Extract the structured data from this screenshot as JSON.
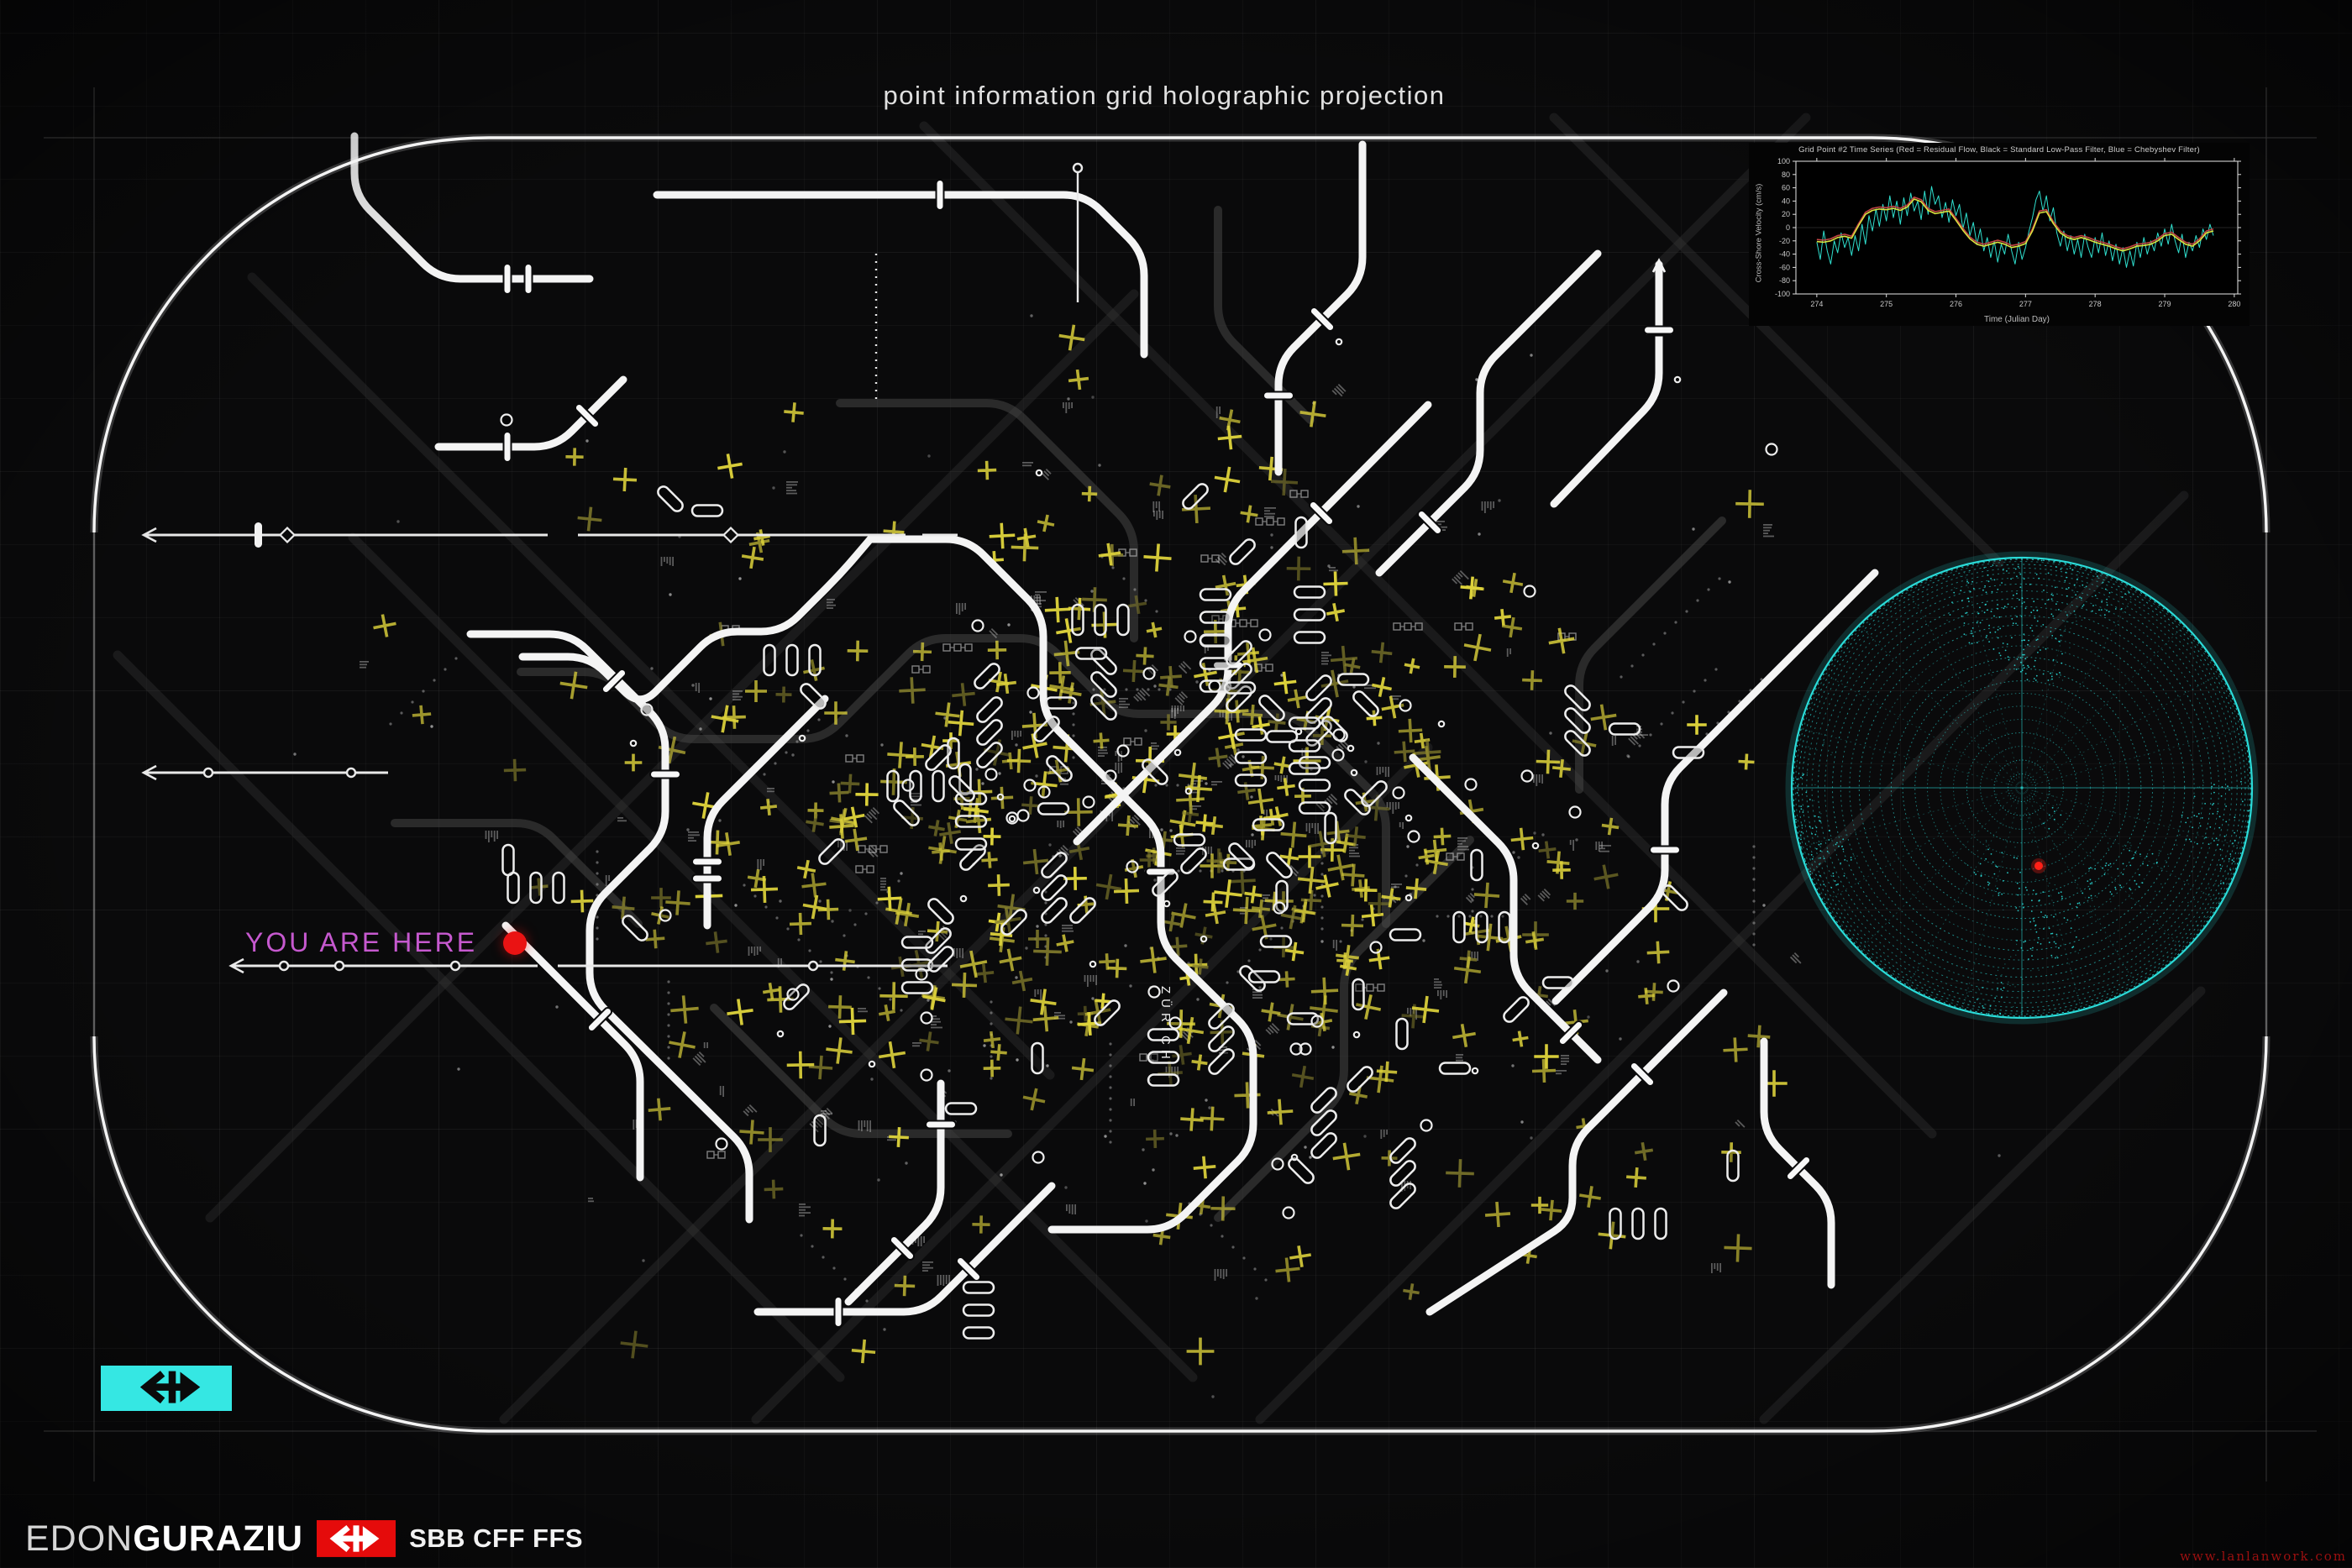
{
  "page": {
    "title": "point information grid holographic projection"
  },
  "map": {
    "you_are_here": "YOU ARE HERE",
    "city_label": "ZÜRICH",
    "colors": {
      "background": "#0a0a0b",
      "route_white": "#f4f4f4",
      "route_dim": "#434343",
      "mark_yellow": "#ddd23b",
      "mark_yellow_dim": "#86802d",
      "label_magenta": "#c659cf",
      "locator_red": "#ea1313",
      "frame_white": "#f2f2f2"
    }
  },
  "chart_data": {
    "type": "line",
    "title": "Grid Point #2 Time Series (Red = Residual Flow, Black = Standard Low-Pass Filter, Blue = Chebyshev Filter)",
    "xlabel": "Time (Julian Day)",
    "ylabel": "Cross-Shore Velocity (cm/s)",
    "xlim": [
      273.7,
      280.05
    ],
    "ylim": [
      -100,
      100
    ],
    "xticks": [
      274,
      275,
      276,
      277,
      278,
      279,
      280
    ],
    "yticks": [
      -100,
      -80,
      -60,
      -40,
      -20,
      0,
      20,
      40,
      60,
      80,
      100
    ],
    "grid": false,
    "legend_position": "none",
    "series": [
      {
        "name": "Residual Flow",
        "color": "#2fe0cf",
        "style": "noisy",
        "x_start": 274.0,
        "x_step": 0.05,
        "values": [
          -22,
          -48,
          -5,
          -35,
          -55,
          -20,
          -38,
          -8,
          -30,
          -15,
          -42,
          -12,
          -35,
          5,
          -25,
          18,
          -5,
          28,
          2,
          35,
          10,
          48,
          15,
          40,
          5,
          45,
          18,
          52,
          25,
          40,
          12,
          55,
          20,
          62,
          35,
          48,
          15,
          38,
          8,
          42,
          18,
          35,
          -2,
          22,
          -12,
          8,
          -25,
          -2,
          -35,
          -15,
          -45,
          -20,
          -52,
          -25,
          -40,
          -10,
          -35,
          -55,
          -22,
          -48,
          -30,
          -5,
          15,
          42,
          55,
          25,
          48,
          10,
          30,
          -8,
          -28,
          -5,
          -35,
          -12,
          -40,
          -18,
          -45,
          -10,
          -30,
          -45,
          -15,
          -38,
          -8,
          -42,
          -20,
          -50,
          -25,
          -55,
          -30,
          -60,
          -35,
          -58,
          -22,
          -45,
          -15,
          -40,
          -20,
          -35,
          -8,
          -28,
          -2,
          -25,
          5,
          -20,
          -38,
          -10,
          -45,
          -22,
          -35,
          -12,
          -30,
          -2,
          -18,
          5,
          -12
        ]
      },
      {
        "name": "Chebyshev Filter",
        "color": "#c24444",
        "style": "smooth",
        "x_start": 274.0,
        "x_step": 0.1,
        "values": [
          -18,
          -19,
          -17,
          -12,
          -10,
          -13,
          6,
          23,
          29,
          31,
          30,
          32,
          29,
          34,
          46,
          42,
          29,
          24,
          26,
          28,
          14,
          -1,
          -14,
          -22,
          -25,
          -22,
          -19,
          -22,
          -27,
          -25,
          -21,
          -2,
          25,
          27,
          9,
          -5,
          -12,
          -15,
          -12,
          -15,
          -19,
          -22,
          -25,
          -29,
          -32,
          -29,
          -25,
          -24,
          -22,
          -17,
          -9,
          -7,
          -15,
          -22,
          -25,
          -17,
          -5,
          -2
        ]
      },
      {
        "name": "Standard Low-Pass Filter",
        "color": "#d9e23f",
        "style": "smooth",
        "x_start": 274.0,
        "x_step": 0.1,
        "values": [
          -21,
          -22,
          -20,
          -15,
          -13,
          -16,
          3,
          20,
          26,
          28,
          27,
          29,
          26,
          31,
          43,
          39,
          26,
          21,
          23,
          25,
          11,
          -4,
          -17,
          -25,
          -28,
          -25,
          -22,
          -25,
          -30,
          -28,
          -24,
          -5,
          22,
          24,
          6,
          -8,
          -15,
          -18,
          -15,
          -18,
          -22,
          -25,
          -28,
          -32,
          -35,
          -32,
          -28,
          -27,
          -25,
          -20,
          -12,
          -10,
          -18,
          -25,
          -28,
          -20,
          -8,
          -5
        ]
      }
    ]
  },
  "globe": {
    "wire_color": "#2ce4e0",
    "marker_color": "#ff2017"
  },
  "branding": {
    "author_first": "EDON",
    "author_last": "GURAZIU",
    "operator": "SBB CFF FFS",
    "badge_red": "#e50b0b",
    "badge_cyan": "#35e7e3"
  },
  "watermark": "www.lanlanwork.com"
}
